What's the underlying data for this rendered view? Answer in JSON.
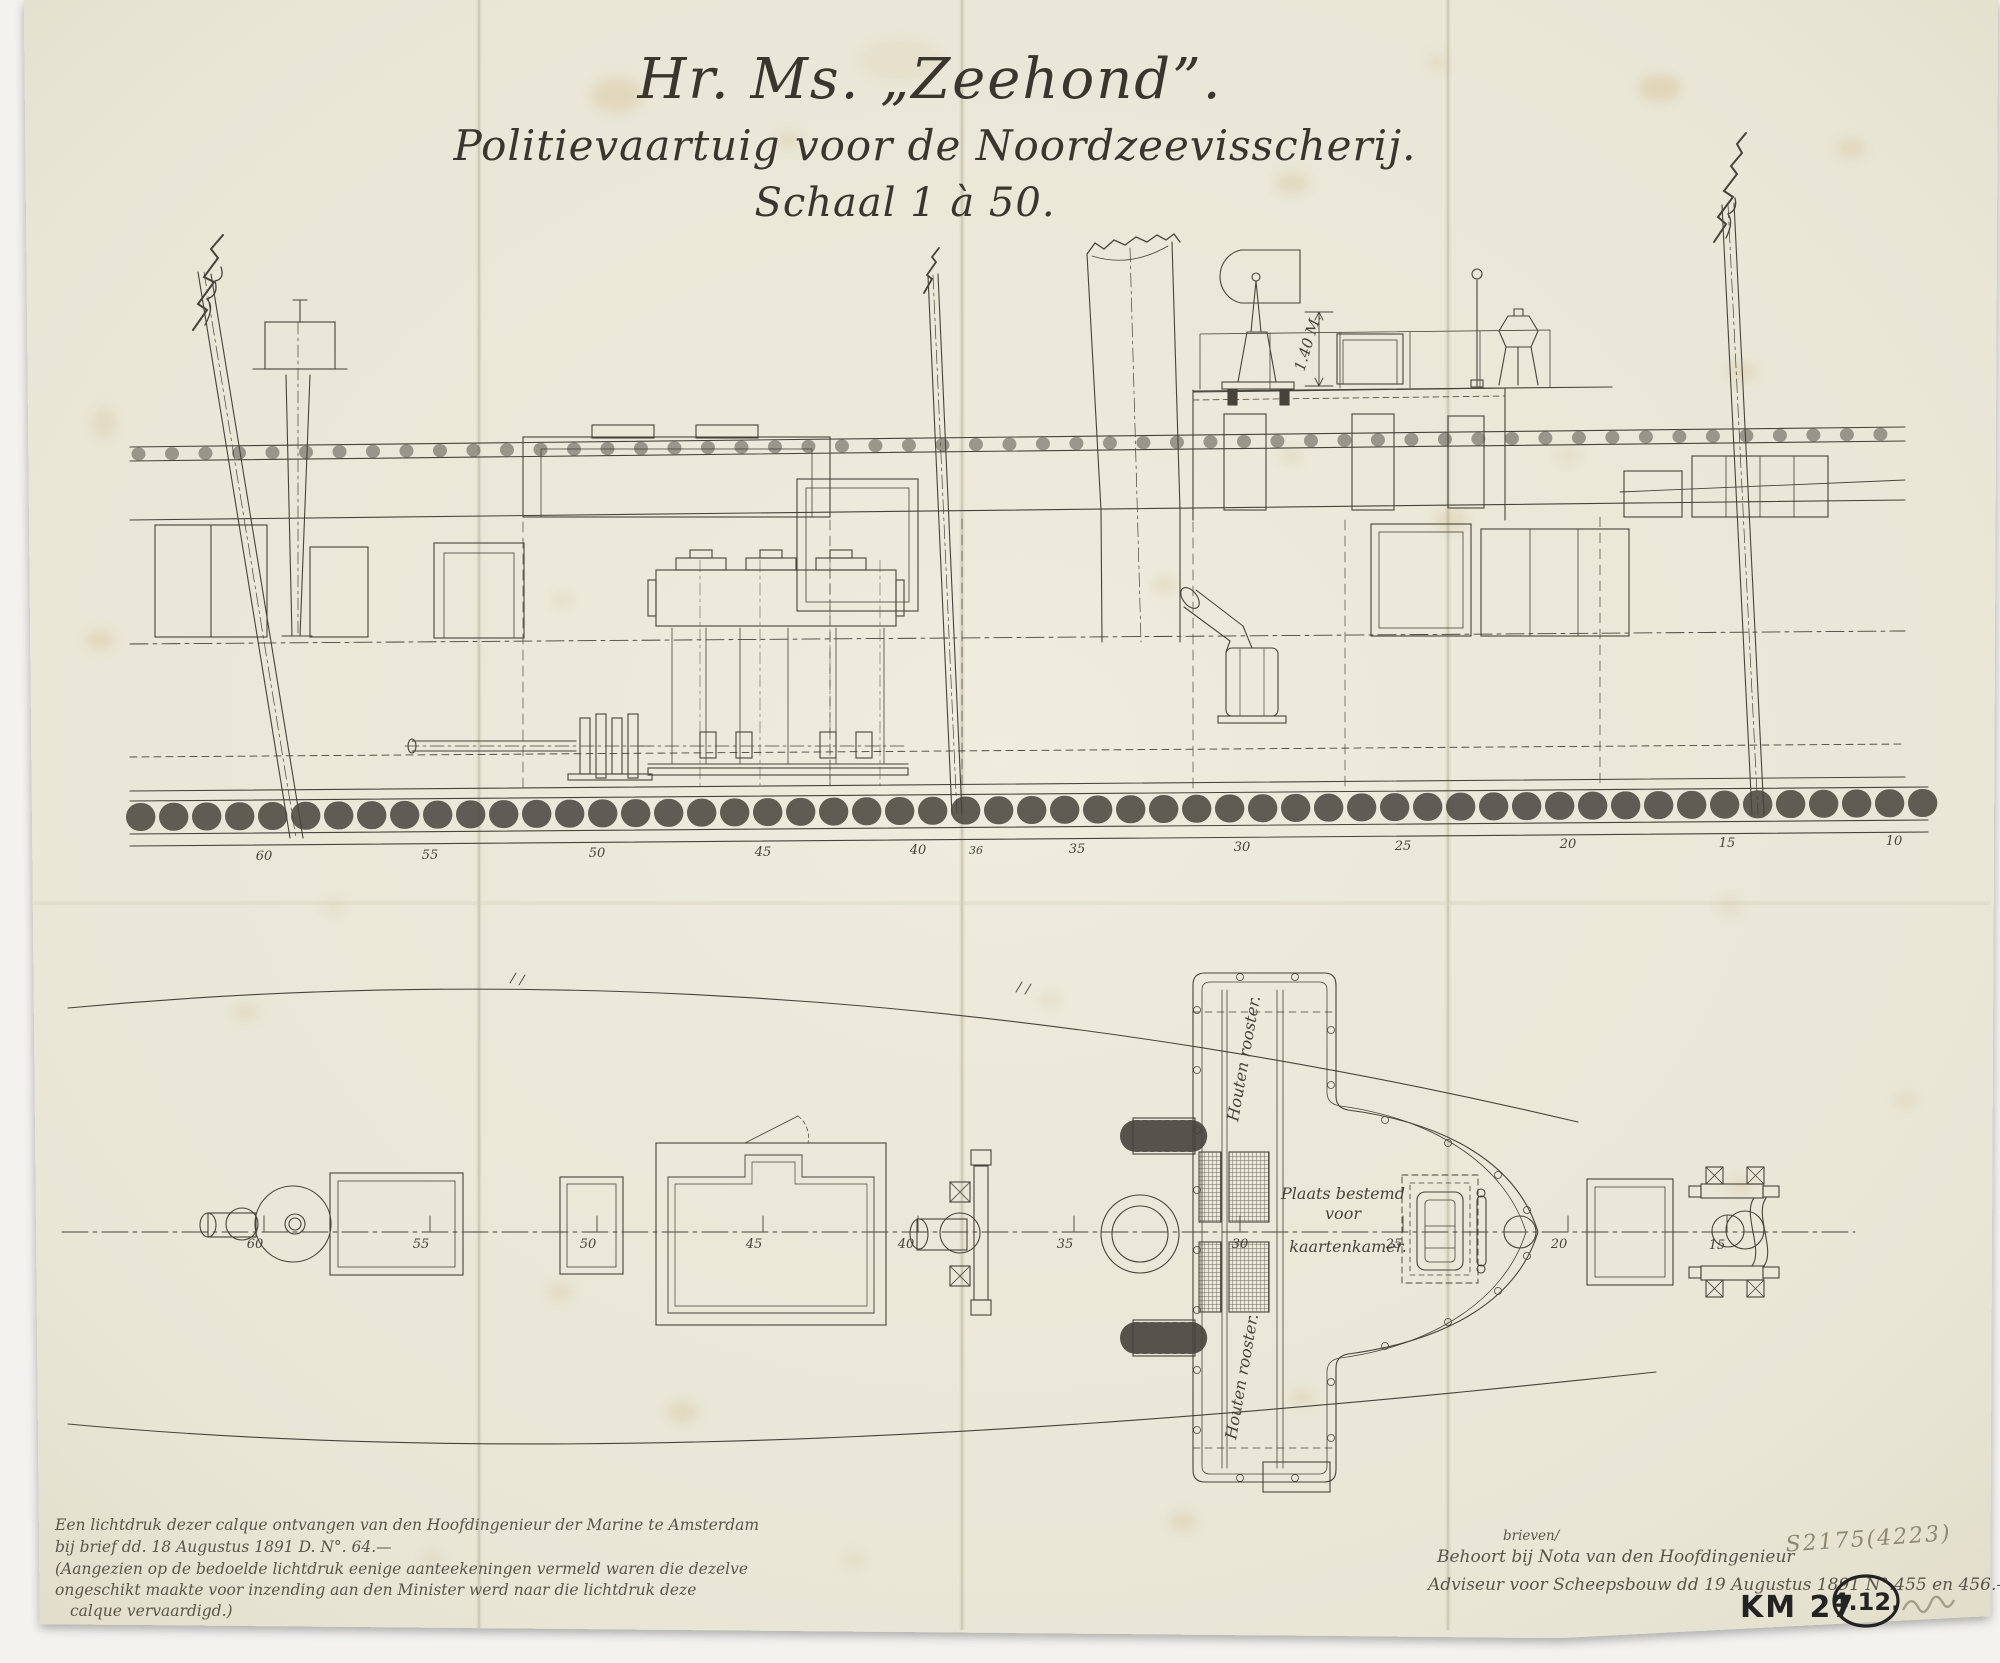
{
  "colors": {
    "paper": "#eae7d8",
    "backdrop": "#f3f2ef",
    "ink": "#45433c",
    "pencil": "#8d8872",
    "marker": "#232323",
    "stain": "#c9a565"
  },
  "title": {
    "line1": "Hr. Ms. „Zeehond”.",
    "line2": "Politievaartuig voor de Noordzeevisscherij.",
    "line3": "Schaal 1 à 50."
  },
  "side_view": {
    "frame_labels": [
      "60",
      "55",
      "50",
      "45",
      "40",
      "36",
      "35",
      "30",
      "25",
      "20",
      "15",
      "10"
    ],
    "dimension_label": "1.40 M."
  },
  "plan_view": {
    "frame_labels": [
      "60",
      "55",
      "50",
      "45",
      "40",
      "35",
      "30",
      "25",
      "20",
      "15"
    ],
    "chart_room_note": [
      "Plaats bestemd",
      "voor",
      "kaartenkamer."
    ],
    "grating_labels": [
      "Houten rooster.",
      "Houten rooster."
    ]
  },
  "notes": {
    "bottom_left": [
      "Een lichtdruk dezer calque ontvangen van den Hoofdingenieur der Marine te Amsterdam",
      "bij brief dd. 18 Augustus 1891 D. N°. 64.—",
      "(Aangezien op de bedoelde lichtdruk eenige aanteekeningen vermeld waren die dezelve",
      "ongeschikt maakte voor inzending aan den Minister werd naar die lichtdruk deze",
      "calque vervaardigd.)"
    ],
    "bottom_right": {
      "inserted_word": "brieven/",
      "line1": "Behoort bij Nota van den Hoofdingenieur",
      "line2": "Adviseur voor Scheepsbouw dd 19 Augustus 1891 N°.455 en 456.—"
    },
    "pencil_mark": "S2175(4223)",
    "stamp_km": "KM 27",
    "stamp_circle": "4.12."
  }
}
